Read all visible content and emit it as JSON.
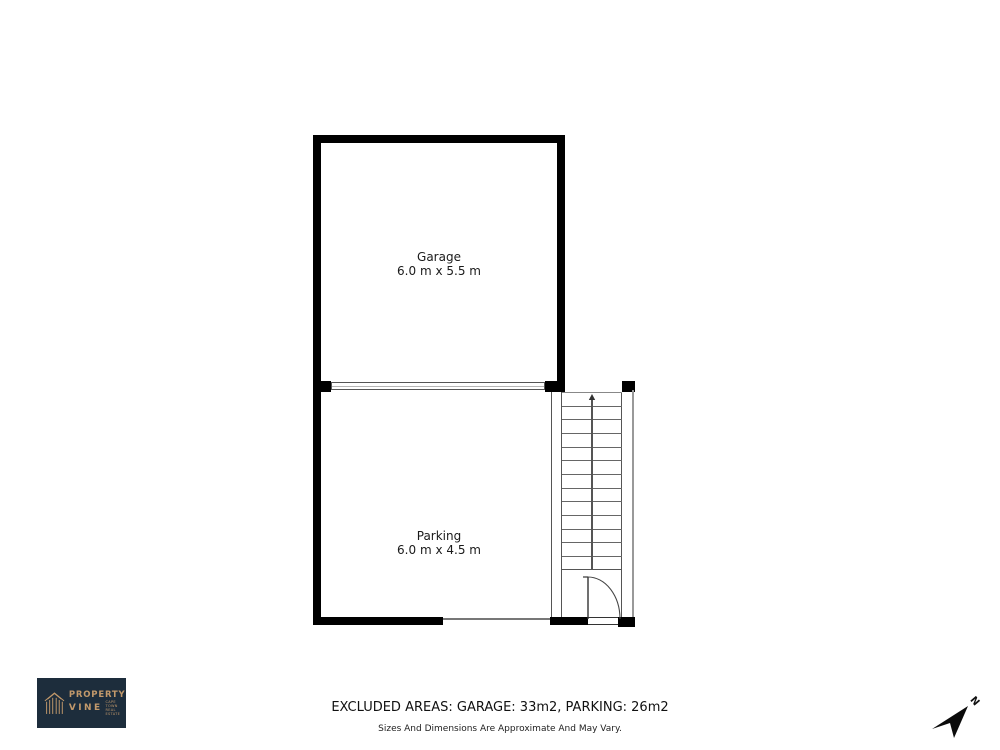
{
  "floorplan": {
    "rooms": [
      {
        "name": "Garage",
        "dimensions": "6.0 m x 5.5 m"
      },
      {
        "name": "Parking",
        "dimensions": "6.0 m x 4.5 m"
      }
    ],
    "stairs": {
      "treads": 12,
      "direction": "up-arrow"
    },
    "compass": {
      "label": "N"
    },
    "colors": {
      "wall": "#000000"
    }
  },
  "logo": {
    "line1": "PROPERTY",
    "line2": "VINE",
    "tagline_line1": "CAPE TOWN",
    "tagline_line2": "REAL ESTATE",
    "icon": "striped-house-icon",
    "colors": {
      "background": "#1d2d3c",
      "foreground": "#c2996b"
    }
  },
  "footer": {
    "excluded_areas": "EXCLUDED AREAS: GARAGE: 33m2, PARKING: 26m2",
    "disclaimer": "Sizes And Dimensions Are Approximate And May Vary."
  }
}
